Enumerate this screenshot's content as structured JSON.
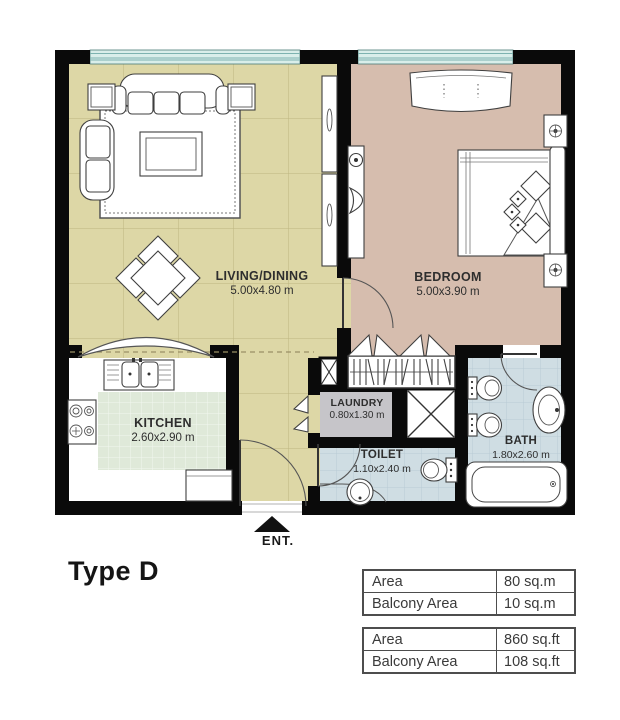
{
  "title": "Type D",
  "entrance_label": "ENT.",
  "rooms": {
    "living": {
      "name": "LIVING/DINING",
      "dims": "5.00x4.80 m"
    },
    "bedroom": {
      "name": "BEDROOM",
      "dims": "5.00x3.90 m"
    },
    "kitchen": {
      "name": "KITCHEN",
      "dims": "2.60x2.90 m"
    },
    "laundry": {
      "name": "LAUNDRY",
      "dims": "0.80x1.30 m"
    },
    "toilet": {
      "name": "TOILET",
      "dims": "1.10x2.40 m"
    },
    "bath": {
      "name": "BATH",
      "dims": "1.80x2.60 m"
    }
  },
  "area_tables": [
    {
      "rows": [
        {
          "label": "Area",
          "value": "80 sq.m"
        },
        {
          "label": "Balcony Area",
          "value": "10 sq.m"
        }
      ]
    },
    {
      "rows": [
        {
          "label": "Area",
          "value": "860 sq.ft"
        },
        {
          "label": "Balcony Area",
          "value": "108 sq.ft"
        }
      ]
    }
  ],
  "colors": {
    "wall": "#0a0a0a",
    "floor_living": "#ddd7a6",
    "floor_bedroom": "#d6bdae",
    "floor_bath": "#cfdde3",
    "floor_laundry": "#c6c5c9",
    "floor_kitchen_tile": "#dfe9d9",
    "window_glass": "#d9eeea",
    "furniture_stroke": "#3f3f3f",
    "text": "#2e2e2e",
    "table_border": "#4d4d4d"
  }
}
